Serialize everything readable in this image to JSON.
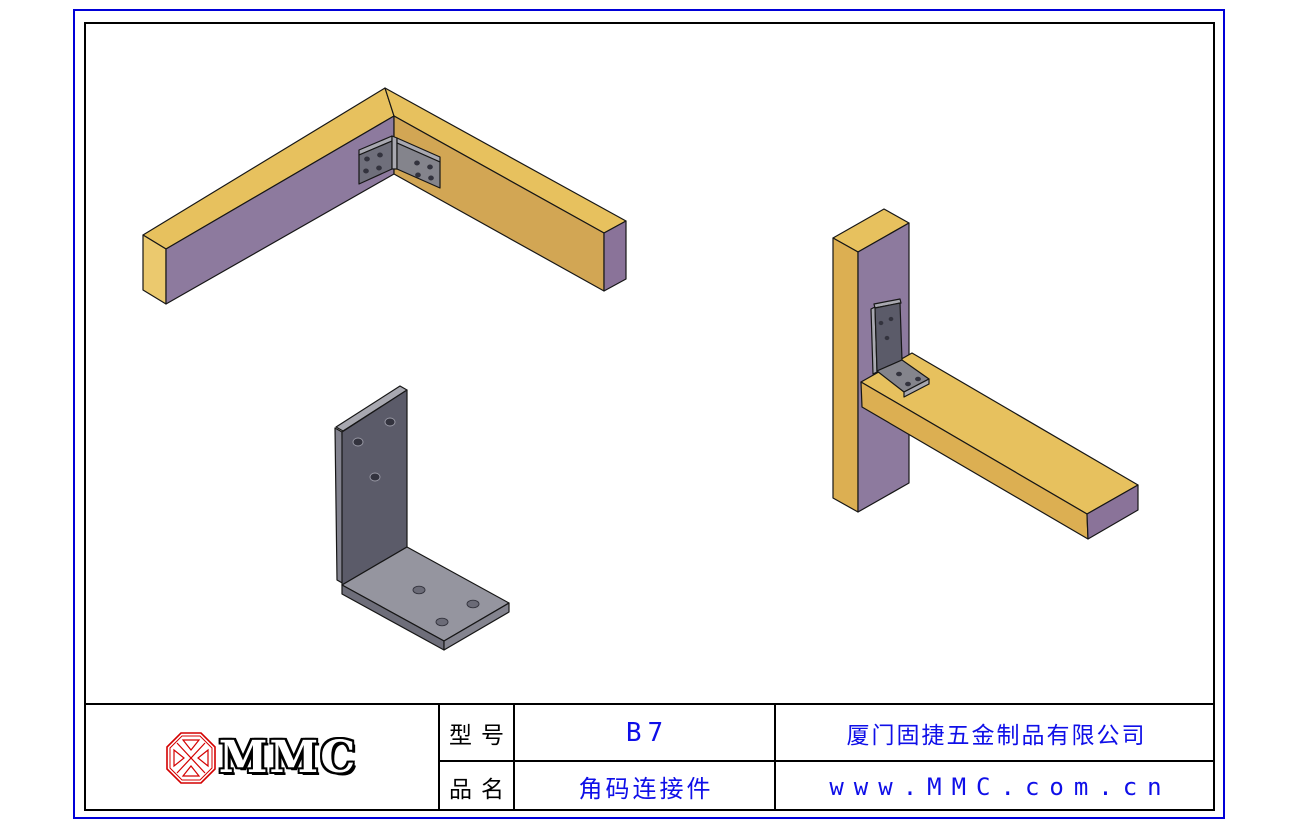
{
  "title_block": {
    "logo": {
      "brand": "MMC",
      "icon": "mmc-diamond"
    },
    "fields": [
      {
        "label": "型号",
        "value": "B7"
      },
      {
        "label": "品名",
        "value": "角码连接件"
      }
    ],
    "company": "厦门固捷五金制品有限公司",
    "website": "www.MMC.com.cn"
  },
  "palette": {
    "border_outer": "#0000d8",
    "border_inner": "#000000",
    "text_blue": "#0f0fe8",
    "text_black": "#000000",
    "logo_red": "#d40000",
    "wood_top": "#e7c15e",
    "wood_side": "#dcaf52",
    "wood_tan": "#d2a654",
    "wood_end_light": "#ebc96e",
    "purple_face": "#8d7a9e",
    "purple_end": "#8a7399",
    "bracket_dark": "#5b5b69",
    "bracket_wing_dark": "#6f6f7b",
    "bracket_mid": "#84848c",
    "bracket_base": "#95959f",
    "bracket_edge_light": "#a8a8b0",
    "bracket_side": "#82828e",
    "base_front_left": "#6e6e7a",
    "base_front_right": "#84848f",
    "hole_dark": "#33333e",
    "hole_base": "#6b6b77",
    "hole_rim": "#34343e",
    "hole_light_rim": "#9a9aa6"
  }
}
